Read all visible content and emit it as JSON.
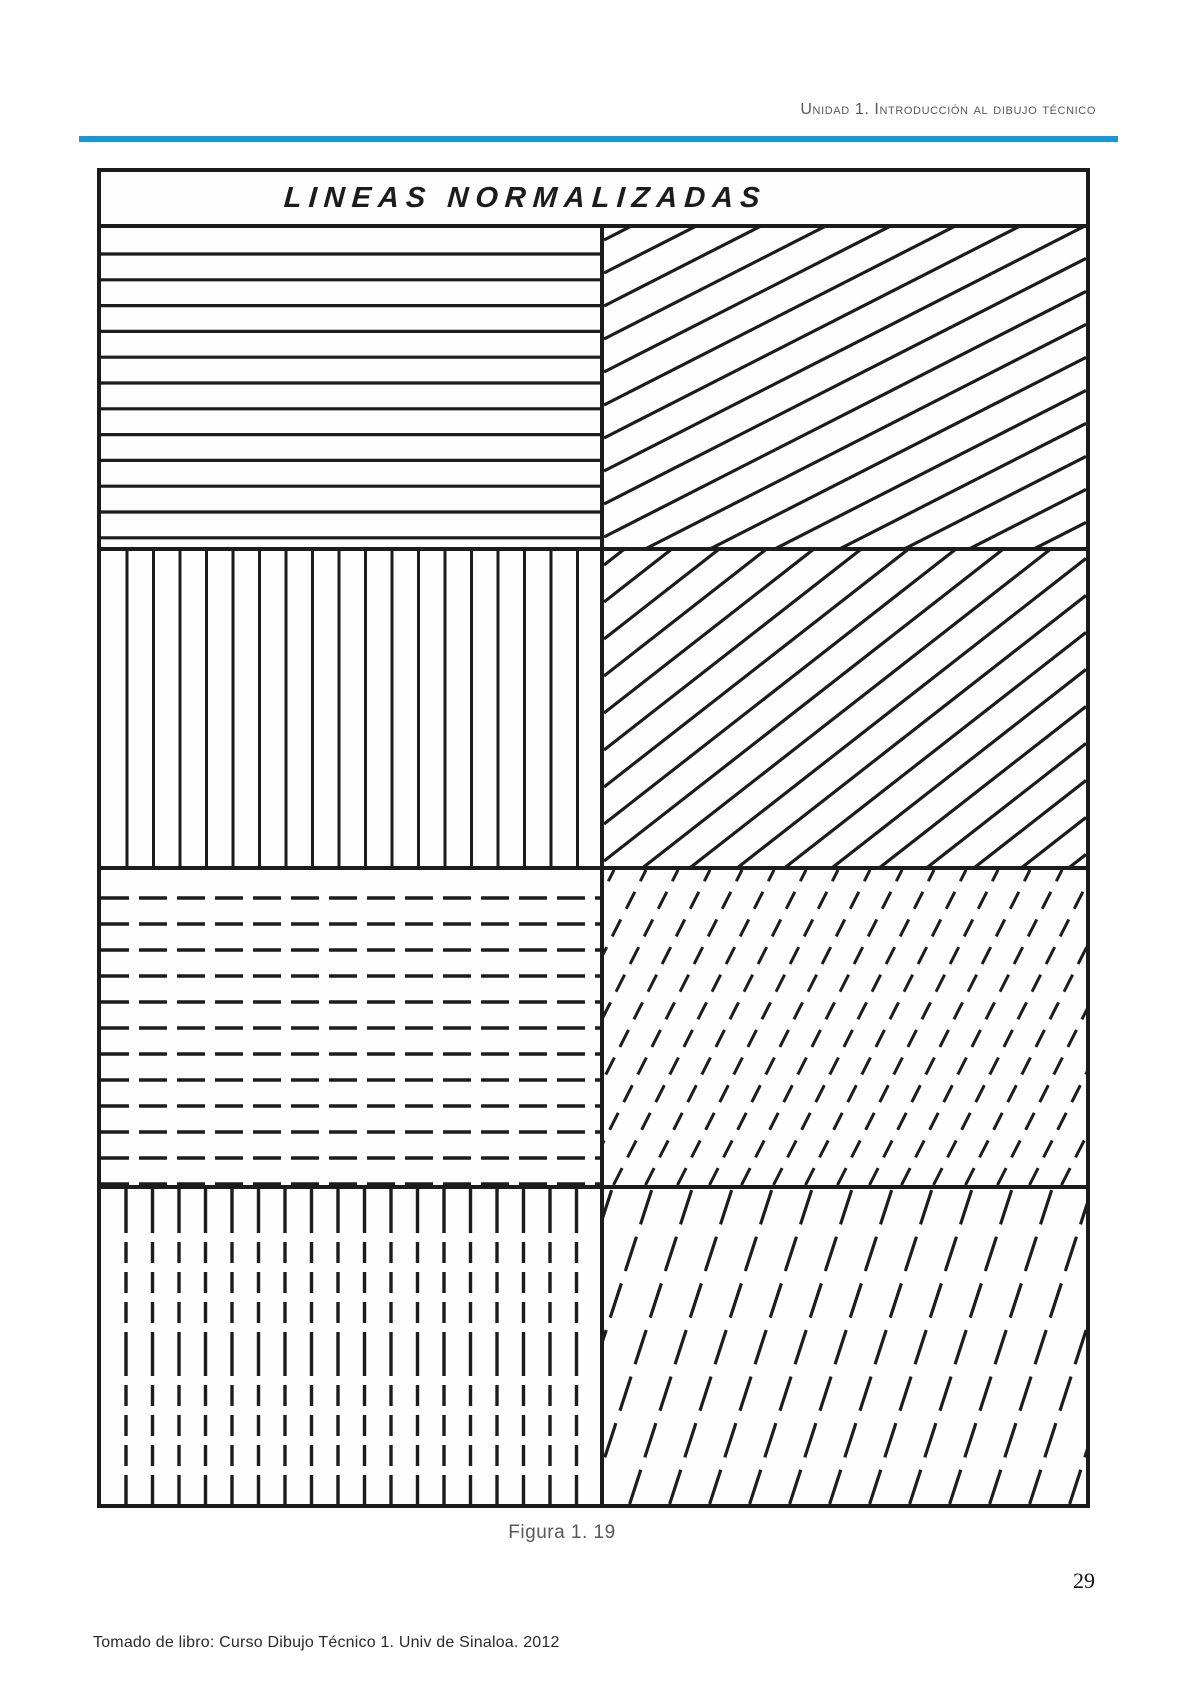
{
  "ink": "#1c1c1c",
  "header": {
    "title": "Unidad 1. Introducción al dibujo técnico",
    "rule_color": "#1798d5"
  },
  "figure": {
    "title": "LINEAS NORMALIZADAS",
    "caption": "Figura 1. 19",
    "panels": [
      {
        "pattern": "horizontal continuous lines",
        "type": "horizontal",
        "first": 26,
        "step": 25.8,
        "stroke": 3.2,
        "dash": null
      },
      {
        "pattern": "diagonal continuous lines, low angle",
        "type": "diagonal",
        "angle_deg": 27,
        "step_axis": "y",
        "first": 12,
        "step": 33,
        "stroke": 3.2,
        "dash": null
      },
      {
        "pattern": "vertical continuous lines",
        "type": "vertical",
        "first": 26,
        "step": 26.5,
        "stroke": 3.0,
        "dash": null
      },
      {
        "pattern": "diagonal continuous lines, medium angle",
        "type": "diagonal",
        "angle_deg": 38,
        "step_axis": "y",
        "first": 14,
        "step": 37,
        "stroke": 3.2,
        "dash": null
      },
      {
        "pattern": "horizontal dashed lines",
        "type": "horizontal",
        "first": 28,
        "step": 26,
        "stroke": 3.4,
        "dash": [
          28,
          10
        ]
      },
      {
        "pattern": "diagonal dashed lines, steep angle",
        "type": "diagonal",
        "angle_deg": 63,
        "step_axis": "x",
        "first": 10,
        "step": 32,
        "stroke": 3.0,
        "dash": [
          19,
          12
        ]
      },
      {
        "pattern": "vertical dashed lines",
        "type": "vertical",
        "first": 25,
        "step": 26.5,
        "stroke": 3.4,
        "dash": [
          44,
          9,
          21,
          9,
          21,
          9,
          21,
          9
        ]
      },
      {
        "pattern": "diagonal long-dash lines, very steep angle",
        "type": "diagonal",
        "angle_deg": 72,
        "step_axis": "x",
        "first": 8,
        "step": 40,
        "stroke": 3.2,
        "dash": [
          36,
          13
        ]
      }
    ]
  },
  "page_number": "29",
  "footer": "Tomado de libro: Curso Dibujo Técnico 1. Univ de Sinaloa. 2012"
}
